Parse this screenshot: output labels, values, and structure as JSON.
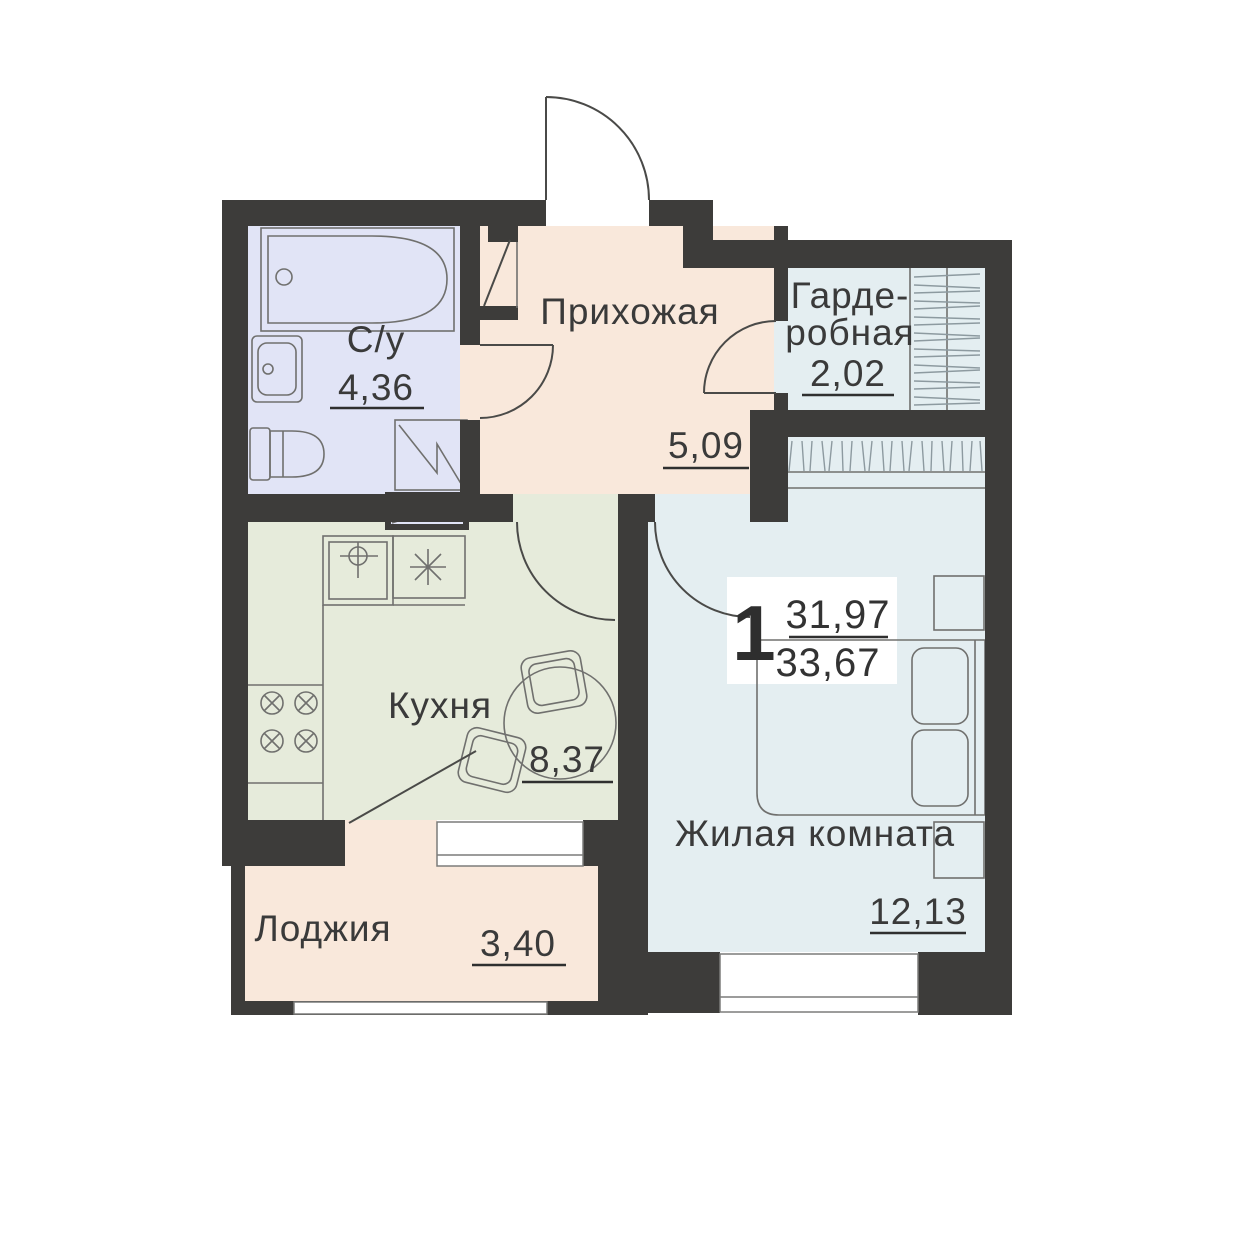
{
  "plan": {
    "badge": {
      "rooms_count": "1",
      "living_area": "31,97",
      "total_area": "33,67"
    },
    "rooms": [
      {
        "id": "bathroom",
        "label": "С/у",
        "area": "4,36"
      },
      {
        "id": "hallway",
        "label": "Прихожая",
        "area": "5,09"
      },
      {
        "id": "wardrobe",
        "label_lines": [
          "Гарде-",
          "робная"
        ],
        "area": "2,02"
      },
      {
        "id": "kitchen",
        "label": "Кухня",
        "area": "8,37"
      },
      {
        "id": "living_room",
        "label": "Жилая комната",
        "area": "12,13"
      },
      {
        "id": "loggia",
        "label": "Лоджия",
        "area": "3,40"
      }
    ],
    "colors": {
      "wall": "#3d3c3a",
      "bathroom": "#e1e4f6",
      "hallway": "#f9e8db",
      "wardrobe": "#e4eef1",
      "kitchen": "#e6ebdb",
      "living_room": "#e4eef1",
      "loggia": "#f9e8db",
      "text": "#3a3a3a",
      "badge_bg": "#ffffff"
    }
  }
}
